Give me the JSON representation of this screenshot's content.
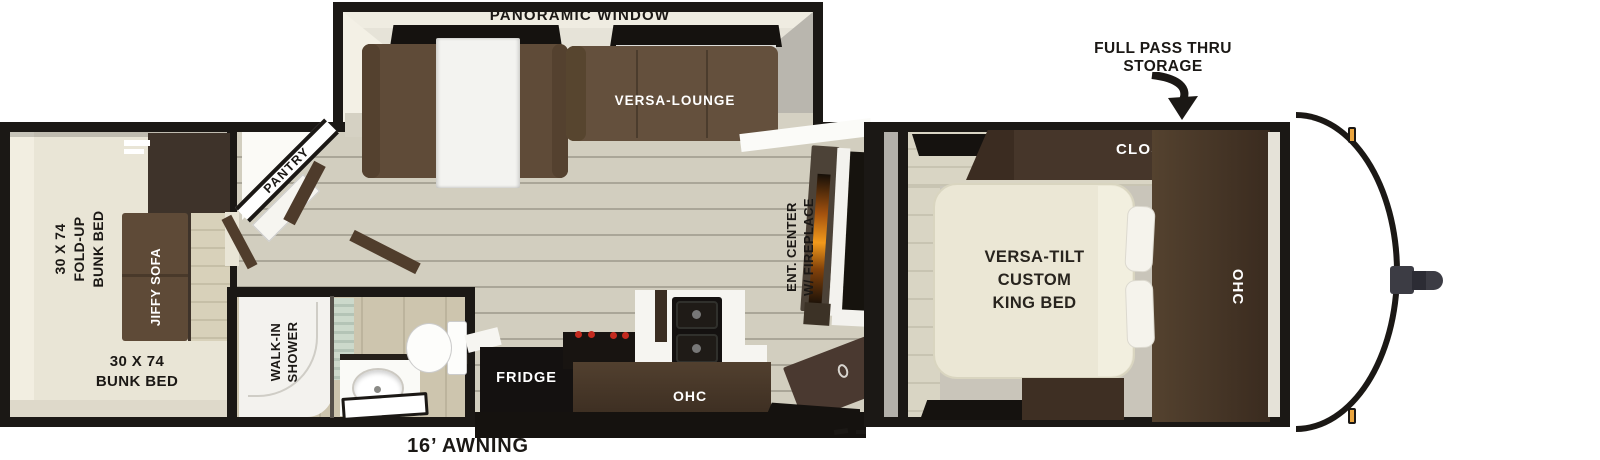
{
  "plan_title": "travel trailer floor plan",
  "slide_top": {
    "window": "PANORAMIC WINDOW",
    "lounge": "VERSA-LOUNGE"
  },
  "bunk_room": {
    "fold_up": "30 X 74\nFOLD-UP\nBUNK BED",
    "sofa": "JIFFY SOFA",
    "bunk": "30 X 74\nBUNK BED"
  },
  "kitchen": {
    "pantry": "PANTRY",
    "fridge": "FRIDGE",
    "ohc": "OHC"
  },
  "living": {
    "ent_center": "ENT. CENTER\nW/ FIREPLACE"
  },
  "bath": {
    "shower": "WALK-IN\nSHOWER"
  },
  "bedroom": {
    "closet": "CLOSET",
    "bed": "VERSA-TILT\nCUSTOM\nKING BED",
    "ohc": "OHC"
  },
  "exterior": {
    "storage": "FULL PASS THRU\nSTORAGE",
    "awning": "16’ AWNING"
  },
  "colors": {
    "wall": "#1b1815",
    "floor": "#d2cebf",
    "sofa_brown": "#5f4b38",
    "cabinet_brown": "#46362a",
    "appliance_black": "#141110",
    "bed_cream": "#ebe7d5",
    "flame_orange": "#f29a1b",
    "marker_amber": "#eaa53e",
    "shower_glass_green": "#c4d4c5"
  }
}
